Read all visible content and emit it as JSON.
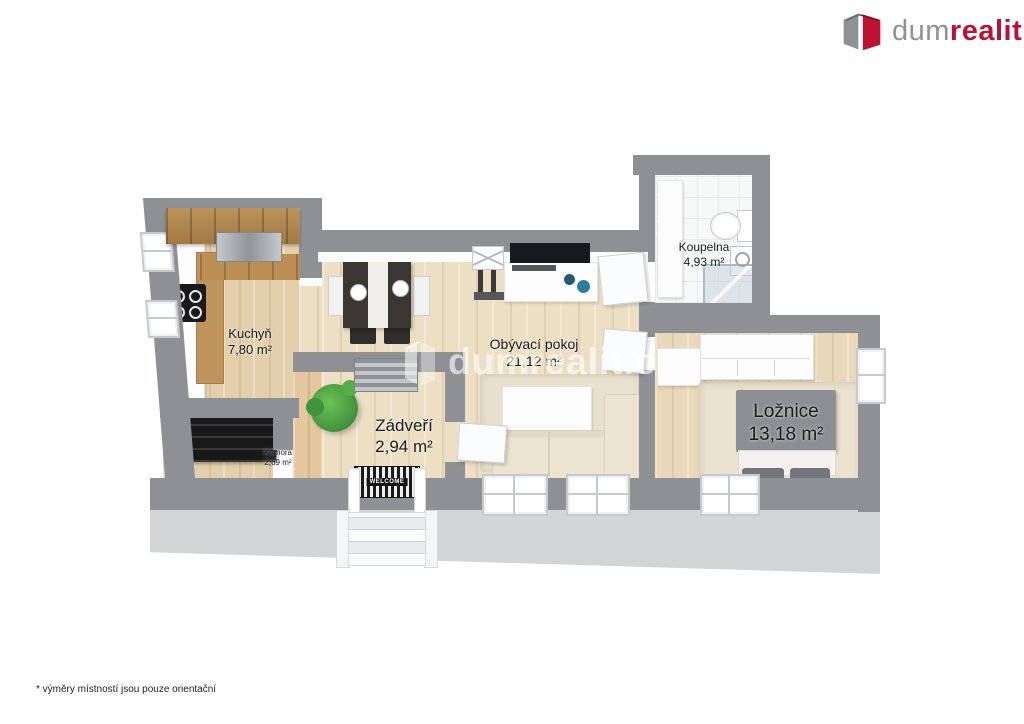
{
  "brand": {
    "prefix": "dum",
    "accent": "realit",
    "suffix": ".cz"
  },
  "watermark": {
    "text": "dumrealit.cz"
  },
  "rooms": {
    "kuchyn": {
      "name": "Kuchyň",
      "area": "7,80 m²"
    },
    "komora": {
      "name": "Komora",
      "area": "2,69 m²"
    },
    "zadveri": {
      "name": "Zádveří",
      "area": "2,94 m²"
    },
    "obyvaci": {
      "name": "Obývací pokoj",
      "area": "21,12 m²"
    },
    "koupelna": {
      "name": "Koupelna",
      "area": "4,93 m²"
    },
    "loznice": {
      "name": "Ložnice",
      "area": "13,18 m²"
    }
  },
  "entrance": {
    "mat_label": "WELCOME"
  },
  "footer": {
    "note": "* výměry místností jsou pouze orientační"
  },
  "colors": {
    "brand_red": "#b51437",
    "brand_gray": "#8f9194",
    "wall_gray": "#8e9093",
    "wall_face": "#d2d4d6",
    "wood_light": "#ecdfc4",
    "wood_entry": "#e3c79e",
    "tile_white": "#f7f8f8",
    "decor_blue": "#2e7d9e"
  }
}
